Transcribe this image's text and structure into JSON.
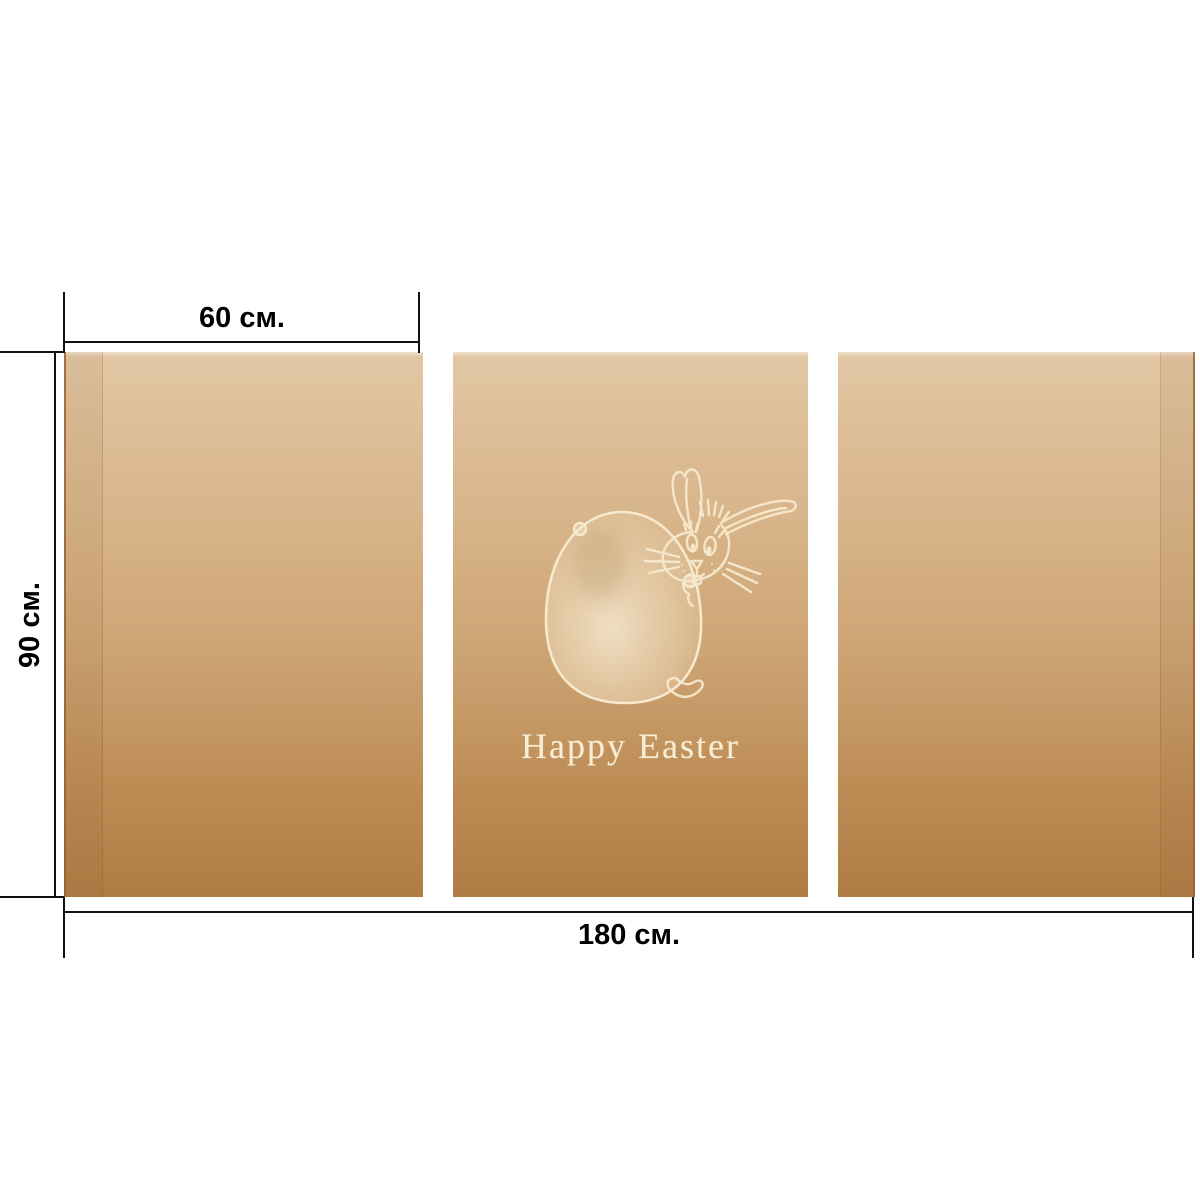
{
  "artwork": {
    "greeting": "Happy Easter",
    "panel_count": 3,
    "icons": [
      "easter-egg-icon",
      "bunny-icon"
    ]
  },
  "dimensions": {
    "panel_width_label": "60 см.",
    "height_label": "90 см.",
    "total_width_label": "180 см."
  },
  "colors": {
    "background": "#ffffff",
    "panel_gradient_top": "#e2c6a4",
    "panel_gradient_bottom": "#b07c46",
    "illustration_line": "#f7e9ce",
    "greeting_text": "#f8edd5",
    "dimension_line": "#111111",
    "dimension_text": "#000000"
  }
}
